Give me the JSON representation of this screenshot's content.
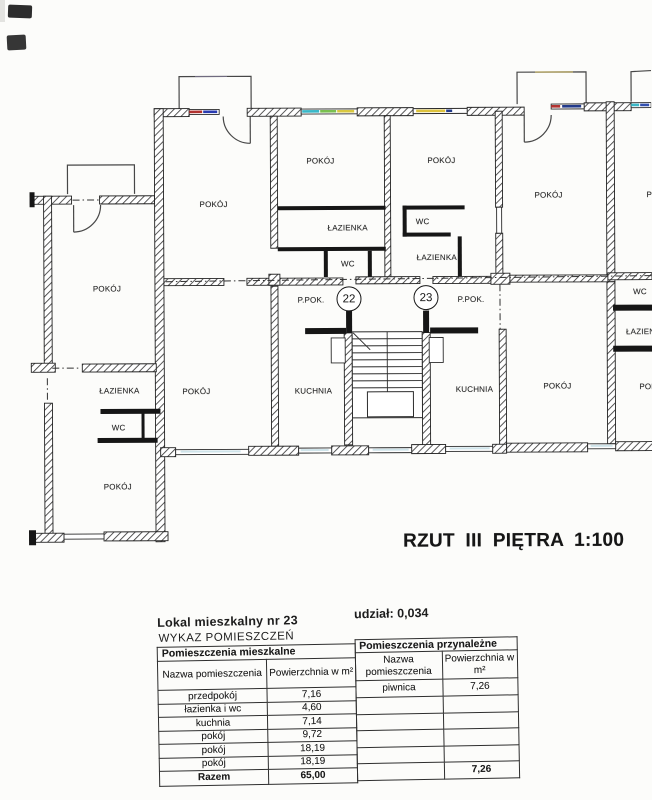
{
  "plan": {
    "title": "RZUT III PIĘTRA 1:100",
    "circles": [
      {
        "number": "22"
      },
      {
        "number": "23"
      }
    ],
    "room_labels": [
      {
        "text": "POKÓJ"
      },
      {
        "text": "ŁAZIENKA"
      },
      {
        "text": "WC"
      },
      {
        "text": "POKÓJ"
      },
      {
        "text": "POKÓJ"
      },
      {
        "text": "POKÓJ"
      },
      {
        "text": "POKÓJ"
      },
      {
        "text": "ŁAZIENKA"
      },
      {
        "text": "WC"
      },
      {
        "text": "P.POK."
      },
      {
        "text": "KUCHNIA"
      },
      {
        "text": "POKÓJ"
      },
      {
        "text": "WC"
      },
      {
        "text": "ŁAZIENKA"
      },
      {
        "text": "P.POK."
      },
      {
        "text": "KUCHNIA"
      },
      {
        "text": "POKÓJ"
      },
      {
        "text": "POKÓJ"
      },
      {
        "text": "WC"
      },
      {
        "text": "ŁAZIENKA"
      },
      {
        "text": "POKÓJ"
      },
      {
        "text": "POKÓJ"
      }
    ]
  },
  "header": {
    "lokal": "Lokal mieszkalny nr 23",
    "udzial": "udział: 0,034",
    "wykaz": "WYKAZ POMIESZCZEŃ"
  },
  "table": {
    "left": {
      "section_title": "Pomieszczenia mieszkalne",
      "col_headers": [
        "Nazwa pomieszczenia",
        "Powierzchnia w m²"
      ],
      "rows": [
        [
          "przedpokój",
          "7,16"
        ],
        [
          "łazienka i wc",
          "4,60"
        ],
        [
          "kuchnia",
          "7,14"
        ],
        [
          "pokój",
          "9,72"
        ],
        [
          "pokój",
          "18,19"
        ],
        [
          "pokój",
          "18,19"
        ]
      ],
      "total_label": "Razem",
      "total_value": "65,00"
    },
    "right": {
      "section_title": "Pomieszczenia przynależne",
      "col_headers": [
        "Nazwa pomieszczenia",
        "Powierzchnia w m²"
      ],
      "rows": [
        [
          "piwnica",
          "7,26"
        ],
        [
          "",
          ""
        ],
        [
          "",
          ""
        ],
        [
          "",
          ""
        ],
        [
          "",
          ""
        ]
      ],
      "total_value": "7,26"
    }
  }
}
